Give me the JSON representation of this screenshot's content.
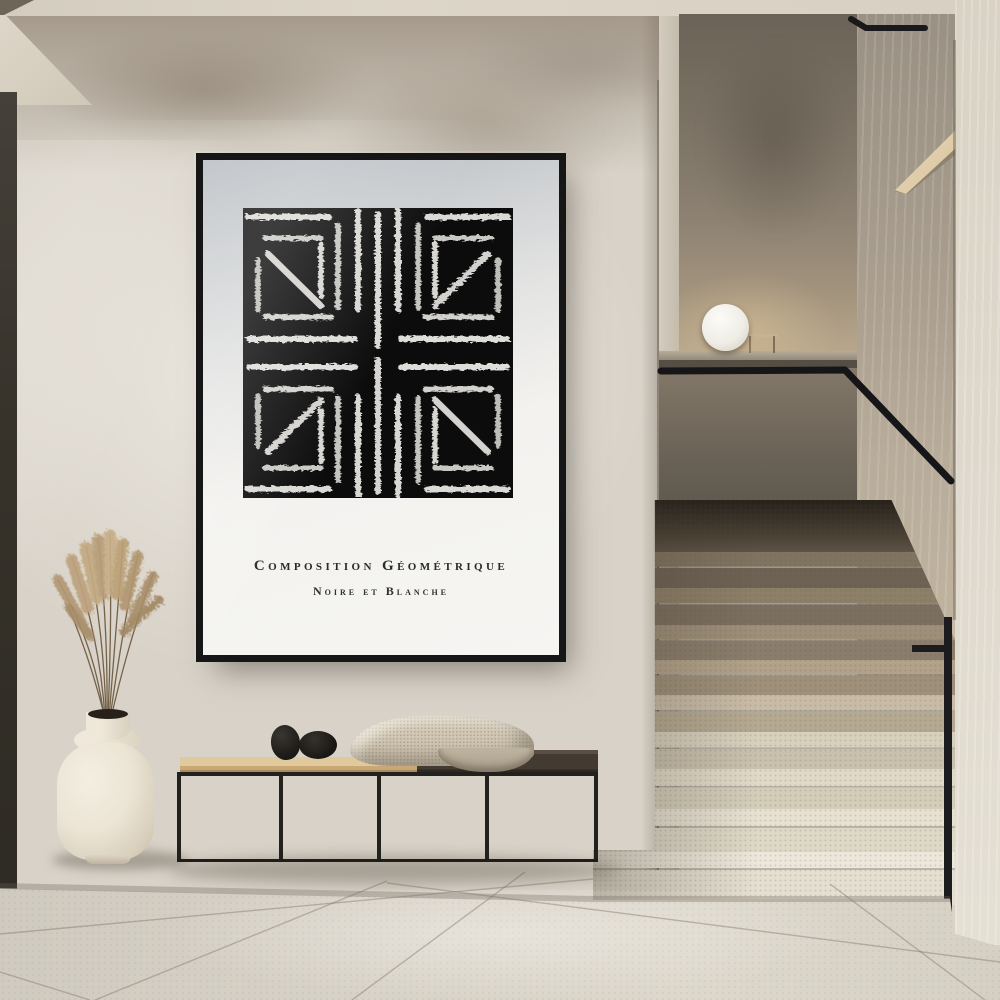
{
  "poster": {
    "title_line1": "Composition Géométrique",
    "title_line2": "Noire et Blanche",
    "art_description": "black square with white brush-stroke geometric pattern in four mirrored quadrants"
  },
  "palette": {
    "frame": "#161616",
    "art_background": "#0c0c0c",
    "brush_stroke": "#e9e8e4",
    "wall": "#d8d2c8",
    "upper_wall": "#9c9082",
    "ceiling": "#d9d2c5",
    "floor": "#d5d0c5",
    "left_door": "#37332b",
    "stair_dark": "#6e6254",
    "stair_light": "#e8e3d6",
    "railing": "#1a191b",
    "bench_wood": "#d5b988",
    "bench_dark_top": "#433a31",
    "blanket": "#cfc5b3",
    "pebbles": "#1c1a17",
    "vase": "#ece5d7",
    "pampas": "#b79c7a",
    "lamp": "#f5f3ed"
  }
}
